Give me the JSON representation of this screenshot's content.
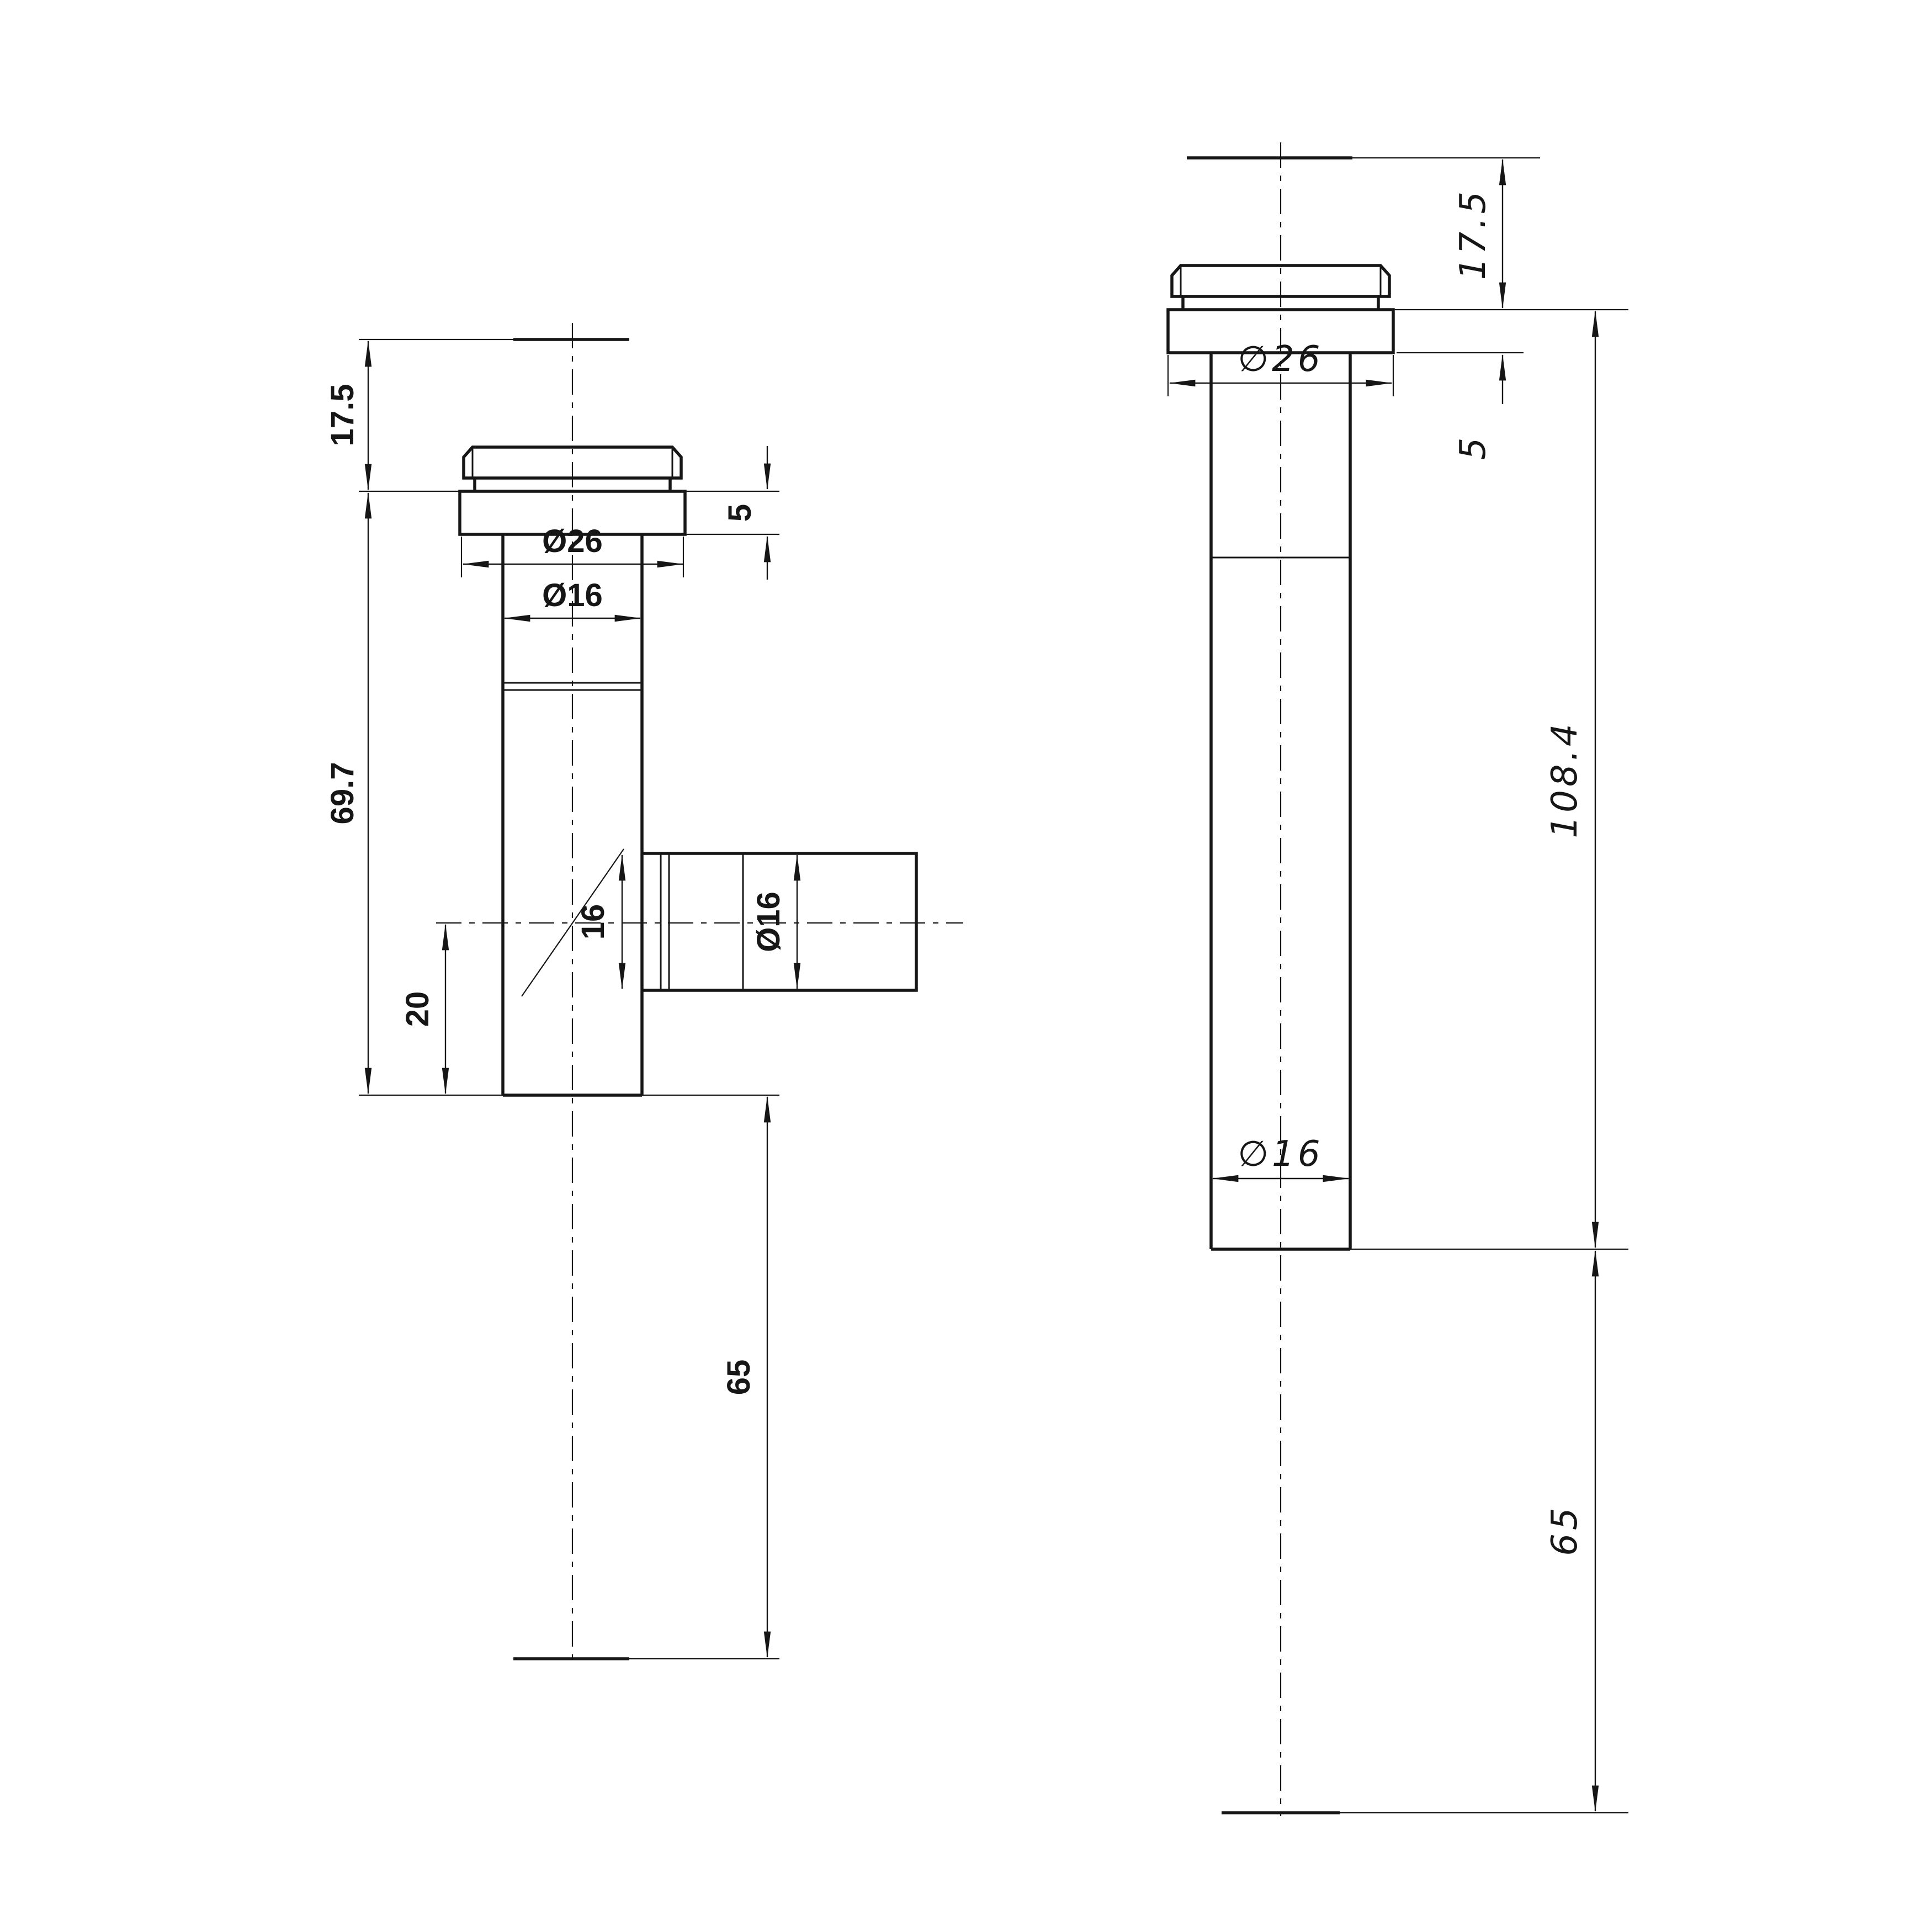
{
  "page": {
    "background": "#ffffff",
    "line_color": "#161616"
  },
  "drawing": {
    "views": {
      "left": {
        "dimensions": {
          "cap_height": "17.5",
          "body_length": "69.7",
          "flange_thickness": "5",
          "flange_diameter": "Ø26",
          "tube_diameter": "Ø16",
          "branch_bore": "16",
          "branch_diameter": "Ø16",
          "branch_center_offset": "20",
          "tail_length": "65"
        }
      },
      "right": {
        "dimensions": {
          "cap_height": "17.5",
          "flange_thickness": "5",
          "flange_diameter": "∅26",
          "overall_length": "108.4",
          "tube_diameter": "∅16",
          "tail_length": "65"
        }
      }
    }
  }
}
